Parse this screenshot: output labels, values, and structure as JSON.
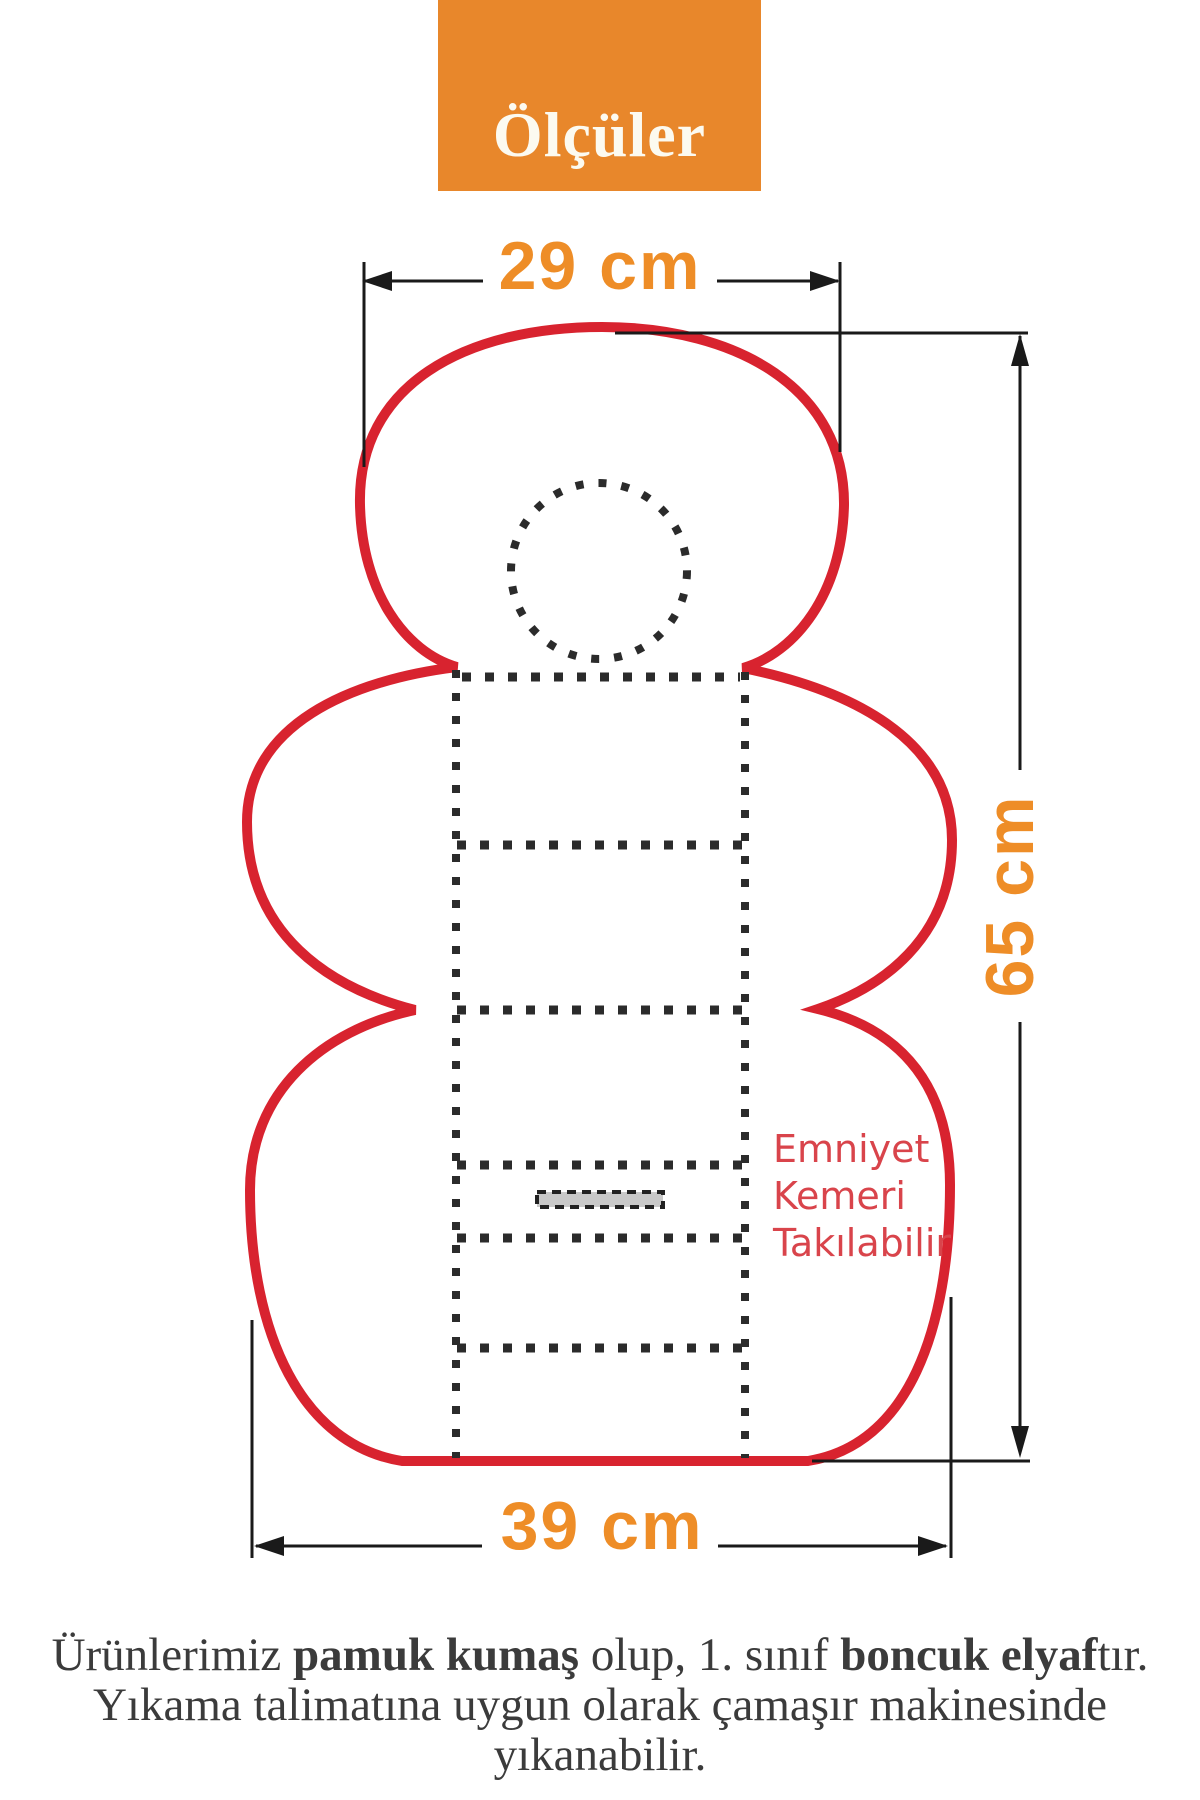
{
  "title": {
    "label": "Ölçüler"
  },
  "dimensions": {
    "top_width": "29 cm",
    "height": "65 cm",
    "bottom_width": "39 cm"
  },
  "belt_note": {
    "line1": "Emniyet",
    "line2": "Kemeri",
    "line3": "Takılabilir"
  },
  "footer": {
    "line1_seg1": "Ürünlerimiz ",
    "line1_seg2_bold": "pamuk kumaş",
    "line1_seg3": " olup, 1. sınıf ",
    "line1_seg4_bold": "boncuk elyaf",
    "line1_seg5": "tır.",
    "line2": "Yıkama talimatına uygun olarak çamaşır makinesinde yıkanabilir."
  },
  "colors": {
    "accent_orange": "#E8872B",
    "dimension_orange": "#EE8D27",
    "outline_red": "#D8232F",
    "note_red": "#D9444B",
    "line_black": "#1A1A1A",
    "stitch_dot": "#2B2B2B",
    "belt_slot_gray": "#C9C9C9",
    "footer_gray": "#3B3B3B"
  }
}
